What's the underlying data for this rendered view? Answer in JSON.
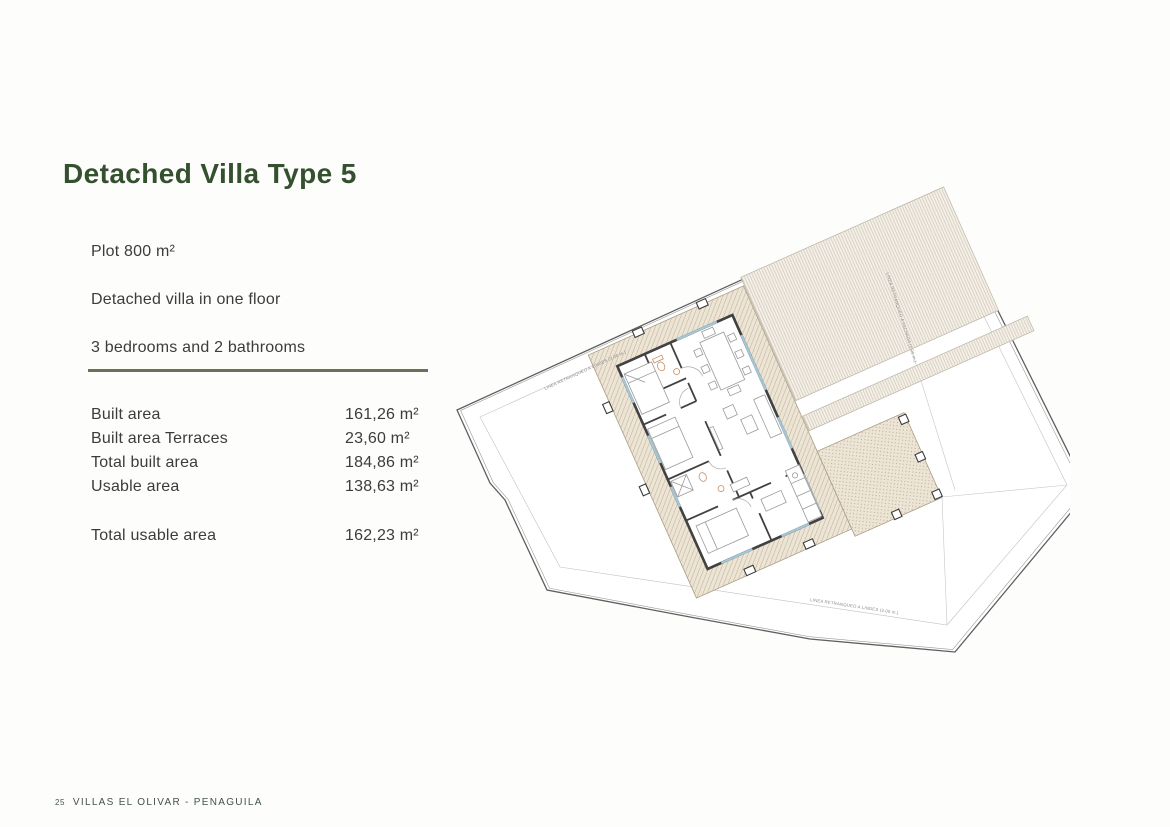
{
  "page": {
    "title": "Detached Villa Type 5",
    "intro_lines": [
      "Plot 800 m²",
      "Detached villa in one floor",
      "3 bedrooms and 2 bathrooms"
    ],
    "areas": [
      {
        "label": "Built area",
        "value": "161,26 m²"
      },
      {
        "label": "Built area Terraces",
        "value": "23,60 m²"
      },
      {
        "label": "Total built area",
        "value": "184,86 m²"
      },
      {
        "label": "Usable area",
        "value": "138,63 m²"
      }
    ],
    "total": {
      "label": "Total usable area",
      "value": "162,23 m²"
    },
    "footer": {
      "page_number": "25",
      "text": "VILLAS EL OLIVAR - PENAGUILA"
    }
  },
  "plan": {
    "labels": {
      "setback_left": "LINEA RETRANQUEO A LINDES (3.00 m.)",
      "setback_bottom": "LINEA RETRANQUEO A LINDES (3.00 m.)",
      "setback_right": "LINEA RETRANQUEO A FACHADA (5.00 m.)"
    }
  },
  "colors": {
    "title_green": "#35502f",
    "body_text": "#3c3c3c",
    "divider_olive": "#6f6f58",
    "footer_green": "#43534a",
    "plan_band_fill": "#ece4d4",
    "plan_hatch": "#b9a88f",
    "plan_wall": "#414141",
    "plan_window_blue": "#a5c6d6"
  }
}
